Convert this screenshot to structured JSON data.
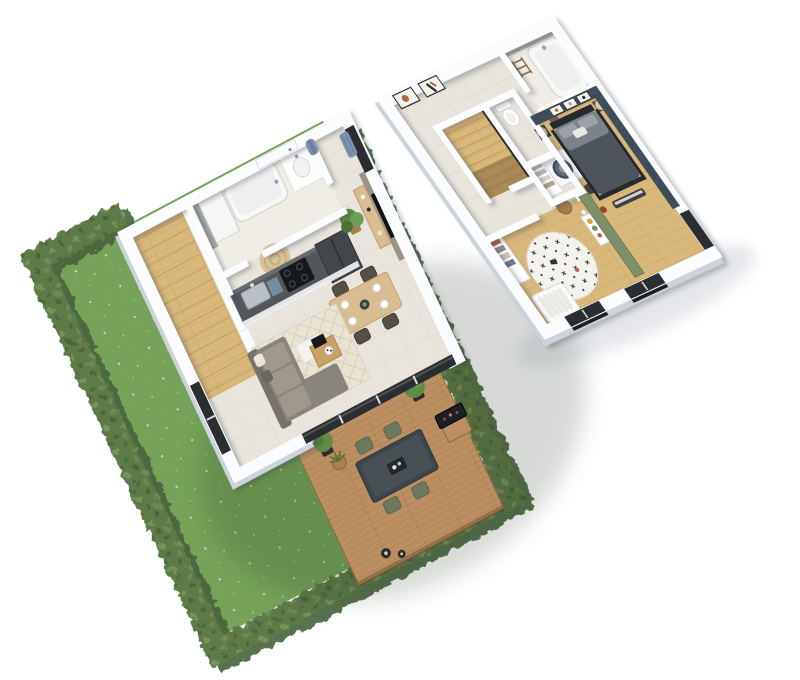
{
  "scene": {
    "title": "3D isometric cutaway floor plan of a two-storey home with garden, terrace and furnished rooms",
    "view": "isometric-cutaway-render",
    "background": "#ffffff",
    "palette": {
      "bg": "#ffffff",
      "wall": "#fbfcfd",
      "wallShade": "#ccd3db",
      "wallLine": "#dfe3e8",
      "tile": "#e9e5dd",
      "cream": "#f0ede6",
      "parquet": "#d9b87c",
      "parquetLine": "#bf9a5e",
      "grass": "#7cab5e",
      "grassLight": "#8fbb6e",
      "hedge": "#5d7a47",
      "hedgeDark": "#46613a",
      "hedgeLight": "#7d9a60",
      "deck": "#bb8f62",
      "deckLine": "#8f6a42",
      "frame": "#2b2e31",
      "sofa": "#8a857c",
      "sofaDark": "#767169",
      "cushion": "#a59f93",
      "rug": "#eae3d3",
      "rugLine": "#d7cebb",
      "woodLight": "#d9bd92",
      "woodMid": "#c9a26a",
      "counter": "#53575b",
      "black": "#1e2023",
      "teal": "#3e4d59",
      "green": "#7f9069",
      "stone": "#b2a99b",
      "jute": "#d9c49a",
      "woven": "#a97f4e",
      "blue": "#7d93ad",
      "olive": "#6d795d",
      "lamp": "#d9cdb2",
      "duvet": "#4e545b",
      "duvetLight": "#7c828a",
      "bedframe": "#26292d",
      "plant": "#5f8c46",
      "plantDark": "#4a7337",
      "terracotta": "#b3654a",
      "steel": "#9aa2a8"
    },
    "floors": [
      {
        "name": "ground-floor",
        "rooms": [
          {
            "name": "entry-hall",
            "items": [
              "front-door",
              "coat-rack-with-blue-coat",
              "window-with-blue-curtain"
            ]
          },
          {
            "name": "staircase",
            "items": [
              "wide-oak-steps",
              "white-stringer-wall"
            ]
          },
          {
            "name": "bathroom",
            "items": [
              "walk-in-shower",
              "grey-tiled-wall",
              "bathtub",
              "washbasin-vanity",
              "round-jute-rug"
            ]
          },
          {
            "name": "kitchen",
            "items": [
              "stainless-sink",
              "faucet",
              "induction-hob",
              "tall-dark-cabinet",
              "dark-counter",
              "white-drawer-fronts",
              "potted-plant"
            ]
          },
          {
            "name": "living-room",
            "items": [
              "corner-sofa",
              "throw-pillows",
              "two-tier-coffee-table",
              "diamond-pattern-rug",
              "taupe-tv-wall",
              "wall-tv",
              "wood-sideboard"
            ]
          },
          {
            "name": "dining-area",
            "items": [
              "wood-dining-table",
              "four-dark-chairs",
              "white-place-settings",
              "center-bowl"
            ]
          },
          {
            "name": "south-glazing",
            "items": [
              "dark-framed-sliding-doors"
            ]
          }
        ]
      },
      {
        "name": "upper-floor",
        "rooms": [
          {
            "name": "landing-hallway",
            "items": [
              "framed-art-1",
              "framed-art-2",
              "stairwell",
              "wicker-hamper",
              "dark-stool",
              "wood-crate"
            ]
          },
          {
            "name": "wc",
            "items": [
              "toilet"
            ]
          },
          {
            "name": "laundry-closet",
            "items": [
              "washing-machine",
              "linen-shelves"
            ]
          },
          {
            "name": "bathroom",
            "items": [
              "bathtub",
              "stone-accent-wall",
              "towel-ladder"
            ]
          },
          {
            "name": "master-bedroom",
            "items": [
              "teal-accent-walls",
              "double-bed-dark-duvet",
              "grey-pillows",
              "two-nightstands",
              "two-beige-lamps",
              "three-wall-frames",
              "foot-bench",
              "red-pouf"
            ]
          },
          {
            "name": "kids-bedroom",
            "items": [
              "round-motif-rug",
              "white-crib",
              "open-wardrobe",
              "toy-shelf",
              "sage-green-partition-wall",
              "toys"
            ]
          },
          {
            "name": "south-windows",
            "items": [
              "dark-framed-juliet-windows",
              "black-railings"
            ]
          }
        ]
      }
    ],
    "garden": {
      "name": "garden",
      "items": [
        "lawn-with-daisies",
        "clipped-hedge-border",
        "timber-deck-terrace",
        "outdoor-dining-table",
        "four-olive-chairs",
        "boxwood-ball-planters",
        "woven-plant-pot",
        "bbq-grill-on-stand",
        "candle-lanterns"
      ]
    }
  }
}
